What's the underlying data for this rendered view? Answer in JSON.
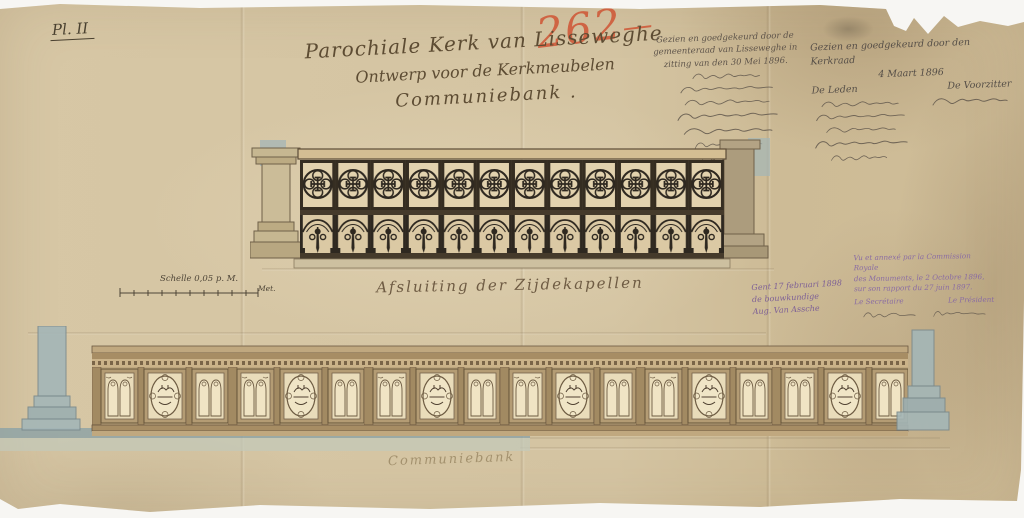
{
  "doc": {
    "plate_label": "Pl. II",
    "inventory_number": "262",
    "inventory_flourish": "—",
    "title_lines": {
      "l1": "Parochiale Kerk van Lisseweghe",
      "l2": "Ontwerp voor de Kerkmeubelen",
      "l3": "Communiebank ."
    },
    "council_approval": {
      "heading": "Gezien en goedgekeurd door de gemeenteraad van Lisseweghe in zitting van den 30 Mei 1896."
    },
    "kerkraad_approval": {
      "heading": "Gezien en goedgekeurd door den Kerkraad",
      "date": "4 Maart 1896",
      "members_label": "De Leden",
      "chairman_label": "De Voorzitter"
    },
    "scale": {
      "label": "Schelle 0,05 p. M.",
      "unit": "Met."
    },
    "captions": {
      "upper": "Afsluiting der Zijdekapellen",
      "lower": "Communiebank"
    },
    "architect_note": {
      "line1": "Gent 17 februari 1898",
      "line2": "de bouwkundige",
      "line3": "Aug. Van Assche"
    },
    "commission_stamp": {
      "line1": "Vu et annexé par la Commission Royale",
      "line2": "des Monuments, le 2 Octobre 1896,",
      "line3": "sur son rapport du 27 juin 1897.",
      "secretary_label": "Le Secrétaire",
      "president_label": "Le Président"
    }
  },
  "drawing": {
    "upper_screen": {
      "bays": 12,
      "subject": "openwork screen with quatrefoil and arched bays between stone piers"
    },
    "lower_bench": {
      "medallion_panels": 6,
      "subject": "gothic panelled communion bench front elevation"
    }
  },
  "colors": {
    "paper": "#d4c4a2",
    "ink": "#2e2820",
    "handwriting_ink": "#5d4c33",
    "red_chalk": "#cf5a3a",
    "purple_ink": "#8a6ca3",
    "pencil": "#5f564b",
    "wood_wash": "#bfa87f",
    "panel_light": "#e9dcba",
    "stone": "#cdc0a0",
    "blue_wash": "#a4b6b7"
  }
}
